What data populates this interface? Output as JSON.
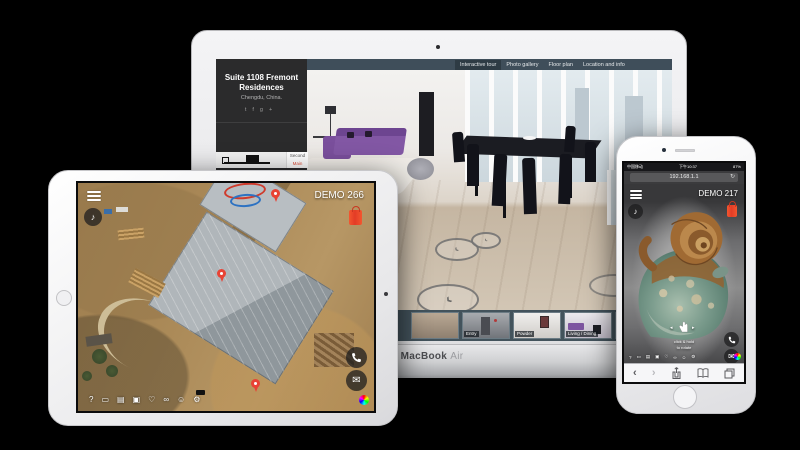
{
  "background_color": "#000000",
  "macbook": {
    "brand": {
      "bold": "MacBook",
      "light": "Air"
    },
    "nav": {
      "tabs": [
        {
          "label": "Interactive tour",
          "active": true
        },
        {
          "label": "Photo gallery",
          "active": false
        },
        {
          "label": "Floor plan",
          "active": false
        },
        {
          "label": "Location and info",
          "active": false
        }
      ]
    },
    "sidebar": {
      "title": "Suite 1108 Fremont Residences",
      "location": "Chengdu, China.",
      "social": [
        {
          "name": "twitter-icon",
          "glyph": "t"
        },
        {
          "name": "facebook-icon",
          "glyph": "f"
        },
        {
          "name": "googleplus-icon",
          "glyph": "g+"
        }
      ],
      "floor_selector": {
        "options": [
          {
            "label": "Second",
            "active": false
          },
          {
            "label": "Main",
            "active": true
          }
        ],
        "active_color": "#e14f39"
      }
    },
    "thumbnails": [
      {
        "label": ""
      },
      {
        "label": "Entry"
      },
      {
        "label": "Powder"
      },
      {
        "label": "Living / Dining"
      },
      {
        "label": "Living"
      }
    ],
    "accent_colors": {
      "navbar": "#3f4e5a",
      "nav_active": "#2e3b44",
      "sidebar": "#2b2b2c"
    }
  },
  "ipad": {
    "demo_label": "DEMO 266",
    "music_glyph": "♪",
    "toolbar": [
      {
        "name": "help-icon",
        "glyph": "?"
      },
      {
        "name": "vr-goggles-icon",
        "glyph": "▭"
      },
      {
        "name": "printer-icon",
        "glyph": "▤"
      },
      {
        "name": "camera-icon",
        "glyph": "▣"
      },
      {
        "name": "heart-icon",
        "glyph": "♡"
      },
      {
        "name": "link-icon",
        "glyph": "∞"
      },
      {
        "name": "smiley-icon",
        "glyph": "☺"
      },
      {
        "name": "settings-icon",
        "glyph": "⚙"
      }
    ],
    "mail_glyph": "✉",
    "marker_color": "#e84335",
    "bag_color": "#e8442e"
  },
  "iphone": {
    "status": {
      "carrier": "中国移动",
      "time": "下午10:37",
      "battery": "87%"
    },
    "url_bar": {
      "address": "192.168.1.1",
      "refresh_glyph": "↻"
    },
    "demo_label": "DEMO 217",
    "music_glyph": "♪",
    "hint": {
      "line1": "click & hold",
      "line2": "to rotate"
    },
    "toolbar": [
      {
        "name": "help-icon",
        "glyph": "?"
      },
      {
        "name": "vr-goggles-icon",
        "glyph": "▭"
      },
      {
        "name": "printer-icon",
        "glyph": "▤"
      },
      {
        "name": "camera-icon",
        "glyph": "▣"
      },
      {
        "name": "heart-icon",
        "glyph": "♡"
      },
      {
        "name": "link-icon",
        "glyph": "∞"
      },
      {
        "name": "smiley-icon",
        "glyph": "☺"
      },
      {
        "name": "settings-icon",
        "glyph": "⚙"
      }
    ],
    "mail_glyph": "✉",
    "safari": {
      "back_glyph": "‹",
      "forward_glyph": "›"
    }
  }
}
